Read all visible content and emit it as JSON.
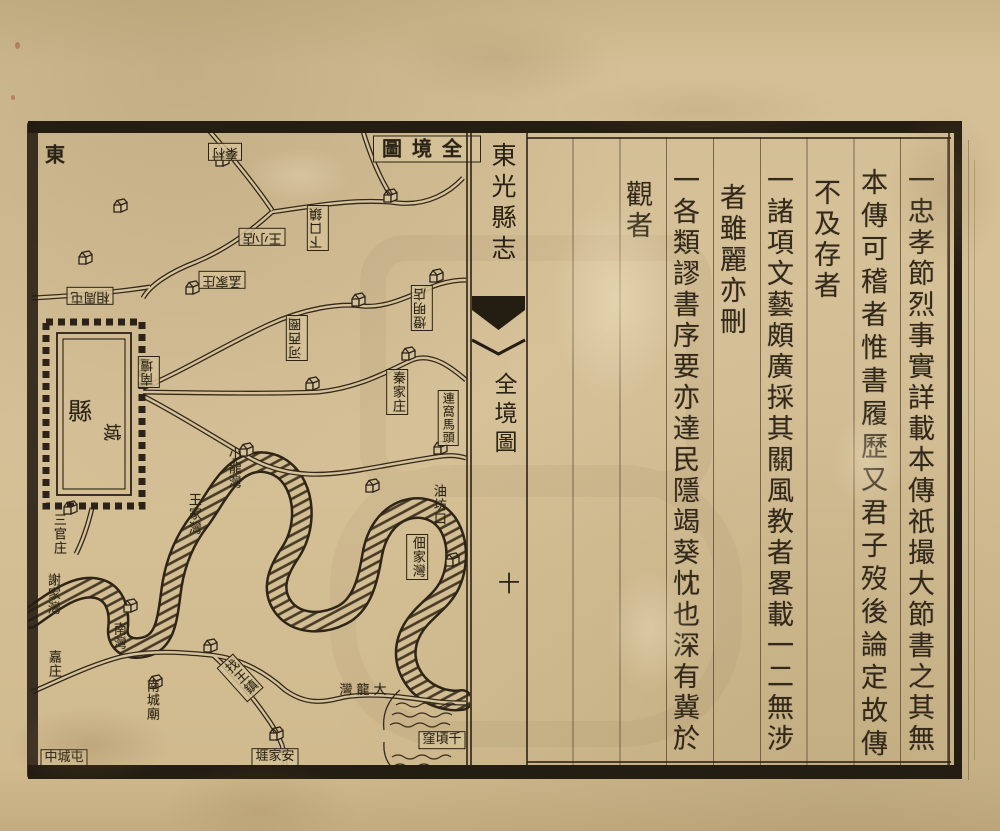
{
  "book": {
    "title": "東光縣志"
  },
  "fold": {
    "book_title": "東光縣志",
    "section_title": "全境圖",
    "page_number": "十"
  },
  "map": {
    "title": "全境圖",
    "title_display": "圖境全",
    "direction_marker": "東",
    "city": {
      "char1": "縣",
      "char2": "城"
    },
    "labels": [
      {
        "text": "秦村",
        "display": "秦村"
      },
      {
        "text": "王小店",
        "display": "王小店"
      },
      {
        "text": "相周屯",
        "display": "相周屯"
      },
      {
        "text": "孟家庄",
        "display": "孟家庄"
      },
      {
        "text": "下口鎮",
        "display": "下口鎮"
      },
      {
        "text": "燈明店",
        "display": "燈明店"
      },
      {
        "text": "河西圈",
        "display": "河西圈"
      },
      {
        "text": "南壇",
        "display": "南壇"
      },
      {
        "text": "秦家庄",
        "display": "秦家庄"
      },
      {
        "text": "連窩馬頭",
        "display": "連窩馬頭"
      },
      {
        "text": "小龍灣",
        "display": "小龍灣"
      },
      {
        "text": "王家灣",
        "display": "王家灣"
      },
      {
        "text": "三官庄",
        "display": "三官庄"
      },
      {
        "text": "謝家灣",
        "display": "謝家灣"
      },
      {
        "text": "南灣",
        "display": "南灣"
      },
      {
        "text": "嘉庄",
        "display": "嘉庄"
      },
      {
        "text": "南城廟",
        "display": "南城廟"
      },
      {
        "text": "中城屯",
        "display": "中城屯"
      },
      {
        "text": "找王鎮",
        "display": "找王鎮"
      },
      {
        "text": "大龍灣",
        "display": "灣龍大"
      },
      {
        "text": "安家堐",
        "display": "堐家安"
      },
      {
        "text": "油坊口",
        "display": "油坊口"
      },
      {
        "text": "佃家灣",
        "display": "佃家灣"
      },
      {
        "text": "千頃窪",
        "display": "窪頃千"
      }
    ]
  },
  "text_page": {
    "columns": [
      {
        "text": "一忠孝節烈事實詳載本傳祇撮大節書之其無"
      },
      {
        "text": "本傳可稽者惟書履歷又君子歿後論定故傳"
      },
      {
        "text": "不及存者"
      },
      {
        "text": "一諸項文藝頗廣採其關風教者畧載一二無涉"
      },
      {
        "text": "者雖麗亦刪"
      },
      {
        "text": "一各類謬書序要亦達民隱竭葵忱也深有冀於"
      },
      {
        "text": "觀者"
      }
    ]
  }
}
